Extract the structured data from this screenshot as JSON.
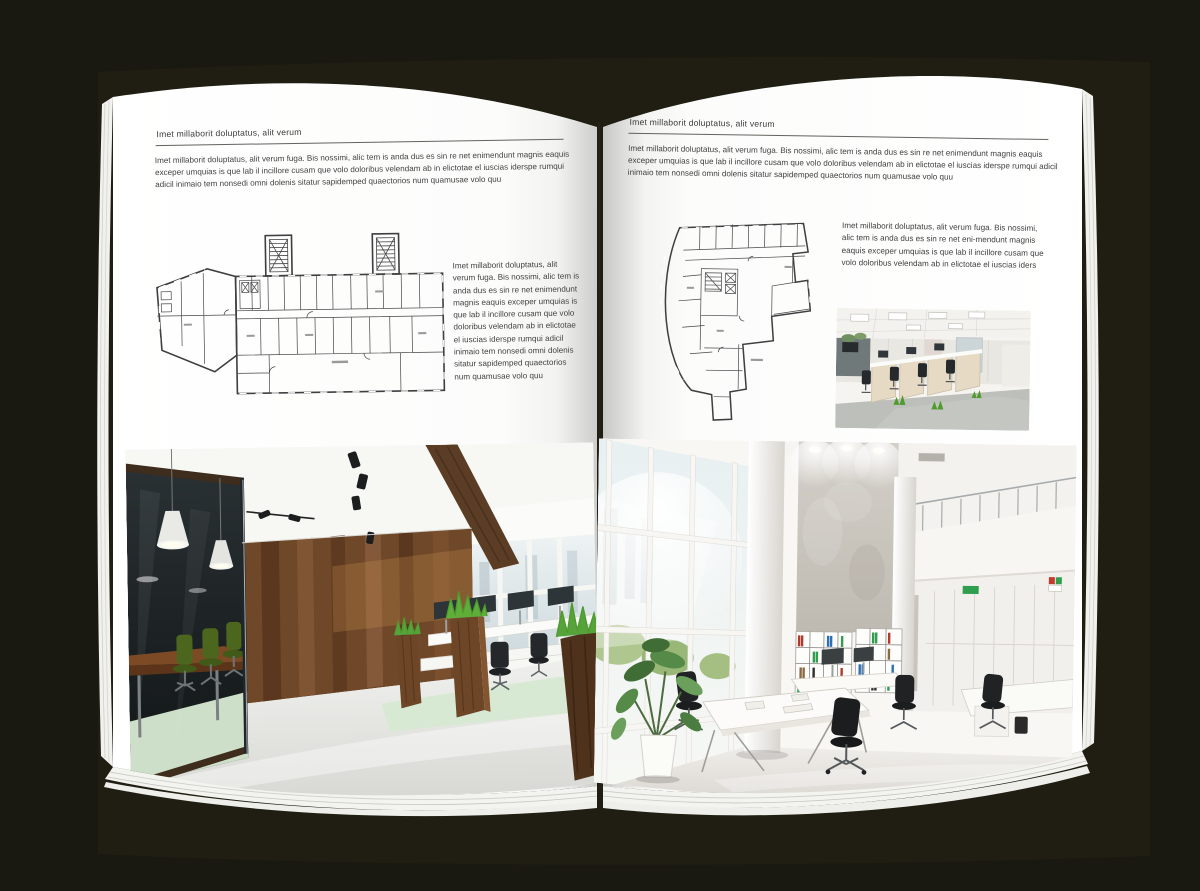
{
  "spread": {
    "page_left": {
      "kicker": "Imet millaborit doluptatus, alit verum",
      "intro": "Imet millaborit doluptatus, alit verum fuga. Bis nossimi, alic tem is anda dus es sin re net enimendunt magnis eaquis exceper umquias is que lab il incillore cusam que volo doloribus velendam ab in elictotae el iuscias iderspe rumqui adicil inimaio tem nonsedi omni dolenis sitatur sapidemped quaectorios num quamusae volo quu",
      "caption": "Imet millaborit doluptatus, alit verum fuga. Bis nossimi, alic tem is anda dus es sin re net enimendunt magnis eaquis exceper umquias is que lab il incillore cusam que volo doloribus velendam ab in elictotae el iuscias iderspe rumqui adicil inimaio tem nonsedi omni dolenis sitatur sapidemped quaectorios num quamusae volo quu"
    },
    "page_right": {
      "kicker": "Imet millaborit doluptatus, alit verum",
      "intro": "Imet millaborit doluptatus, alit verum fuga. Bis nossimi, alic tem is anda dus es sin re net enimendunt magnis eaquis exceper umquias is que lab il incillore cusam que volo doloribus velendam ab in elictotae el iuscias iderspe rumqui adicil inimaio tem nonsedi omni dolenis sitatur sapidemped quaectorios num quamusae volo quu",
      "caption": "Imet millaborit doluptatus, alit verum fuga. Bis nossimi, alic tem is anda dus es sin re net eni-mendunt magnis eaquis exceper umquias is que lab il incillore cusam que volo doloribus velendam ab in elictotae el iuscias iders"
    },
    "colors": {
      "cover": "#201e12",
      "background": "#191811",
      "page": "#ffffff",
      "rule": "#62625e",
      "body_text": "#414141",
      "plan_line": "#47474a",
      "chair_green": "#4c661e",
      "wood_brown": "#6f4829",
      "grass_green": "#4f9b2f",
      "binder_red": "#b23a2c",
      "binder_green": "#2f9e4f",
      "binder_blue": "#2f6fb3"
    }
  }
}
